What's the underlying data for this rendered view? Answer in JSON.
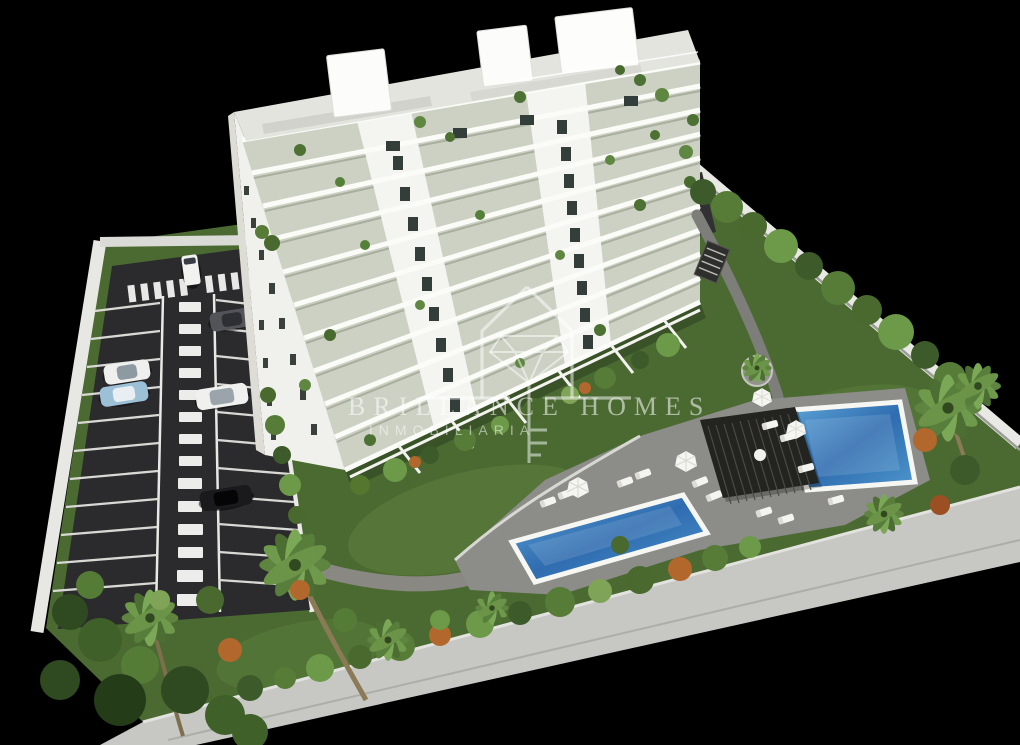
{
  "canvas": {
    "width": 1020,
    "height": 745,
    "background": "#000000"
  },
  "watermark": {
    "brand": "BRILLANCE HOMES",
    "subtitle": "INMOBILIARIA",
    "logo": "house-diamond-key-icon",
    "color": "#ffffff"
  },
  "scene": {
    "type": "3d-architectural-render",
    "subject": "aerial view of a white multi-storey apartment building with landscaped garden, two swimming pools, pergola and private parking lot",
    "building": {
      "floors_visible": 10,
      "facade_color": "#f3f3ef",
      "balcony_glass_color": "#ccd1c4",
      "roof_boxes": 3
    },
    "pools": {
      "count": 2,
      "water_color": "#3f7fbe",
      "coping_color": "#ffffff"
    },
    "pergola": {
      "color": "#23231f"
    },
    "parking": {
      "surface_color": "#2b2b2d",
      "marking_color": "#ffffff",
      "vehicles": [
        {
          "kind": "van",
          "color": "#f2f2f0"
        },
        {
          "kind": "car",
          "color": "#53545a"
        },
        {
          "kind": "car",
          "color": "#efefed"
        },
        {
          "kind": "car",
          "color": "#9cc0d6"
        },
        {
          "kind": "car",
          "color": "#f0f0ee"
        },
        {
          "kind": "car",
          "color": "#1a1a1c"
        }
      ]
    },
    "landscape": {
      "grass_color": "#4b6a32",
      "palm_trees": true,
      "hedges": true,
      "accent_bush_color": "#b2672c"
    },
    "hardscape": {
      "deck_color": "#8c8c89",
      "walkway_color": "#c7c7c4",
      "wall_color": "#e7e7e3",
      "path_color": "#8a8882"
    }
  }
}
